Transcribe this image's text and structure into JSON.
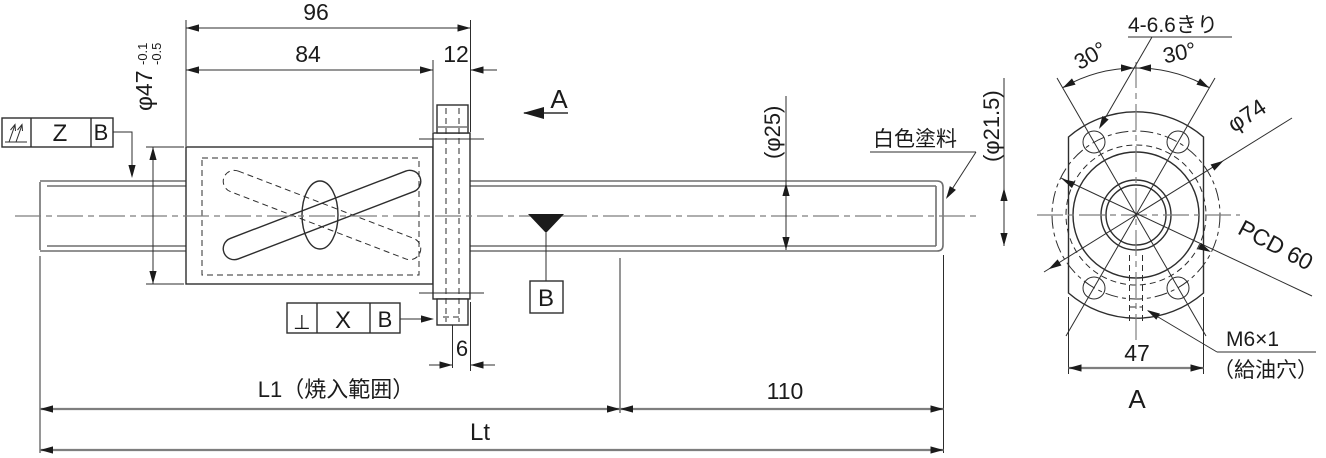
{
  "page": {
    "background": "#ffffff",
    "kind": "ball-screw-technical-drawing"
  },
  "colors": {
    "line_dark": "#2d2d2d",
    "line_gray": "#7e7e7e",
    "text": "#1b1b1b"
  },
  "side_view": {
    "dim_96": "96",
    "dim_84": "84",
    "dim_12": "12",
    "nut_od": "φ47",
    "nut_od_tol_upper": "-0.1",
    "nut_od_tol_lower": "-0.5",
    "runout_frame": {
      "datum": "Z",
      "ref": "B"
    },
    "perp_frame": {
      "symbol": "⊥",
      "datum": "X",
      "ref": "B"
    },
    "section_label": "A",
    "datum_target": "B",
    "screw_od": "(φ25)",
    "paint_note": "白色塗料",
    "screw_root": "(φ21.5)",
    "dim_6": "6",
    "dim_L1": "L1（焼入範囲）",
    "dim_110": "110",
    "dim_Lt": "Lt"
  },
  "end_view": {
    "view_label": "A",
    "holes_note": "4-6.6きり",
    "angle_left": "30°",
    "angle_right": "30°",
    "flange_od": "φ74",
    "pcd": "PCD 60",
    "across_flats": "47",
    "oil_thread": "M6×1",
    "oil_note": "（給油穴）"
  }
}
